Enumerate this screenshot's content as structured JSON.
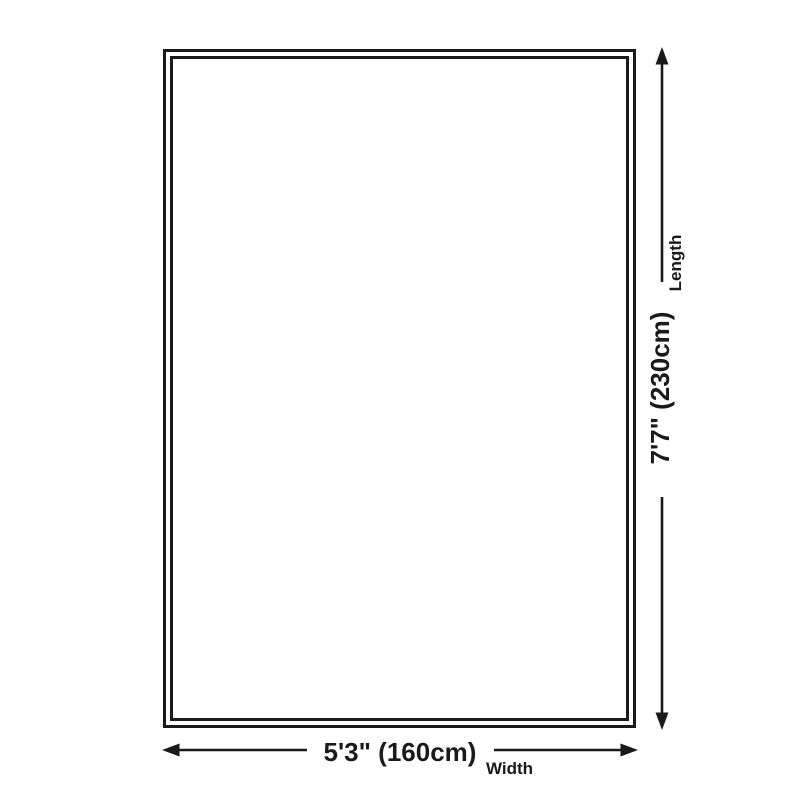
{
  "diagram": {
    "type": "dimension-diagram",
    "background_color": "#ffffff",
    "line_color": "#1a1a1a",
    "length": {
      "value": "7'7\" (230cm)",
      "label": "Length"
    },
    "width": {
      "value": "5'3\" (160cm)",
      "label": "Width"
    },
    "icons": {
      "arrowhead_up": "triangle-up",
      "arrowhead_down": "triangle-down",
      "arrowhead_left": "triangle-left",
      "arrowhead_right": "triangle-right"
    }
  }
}
